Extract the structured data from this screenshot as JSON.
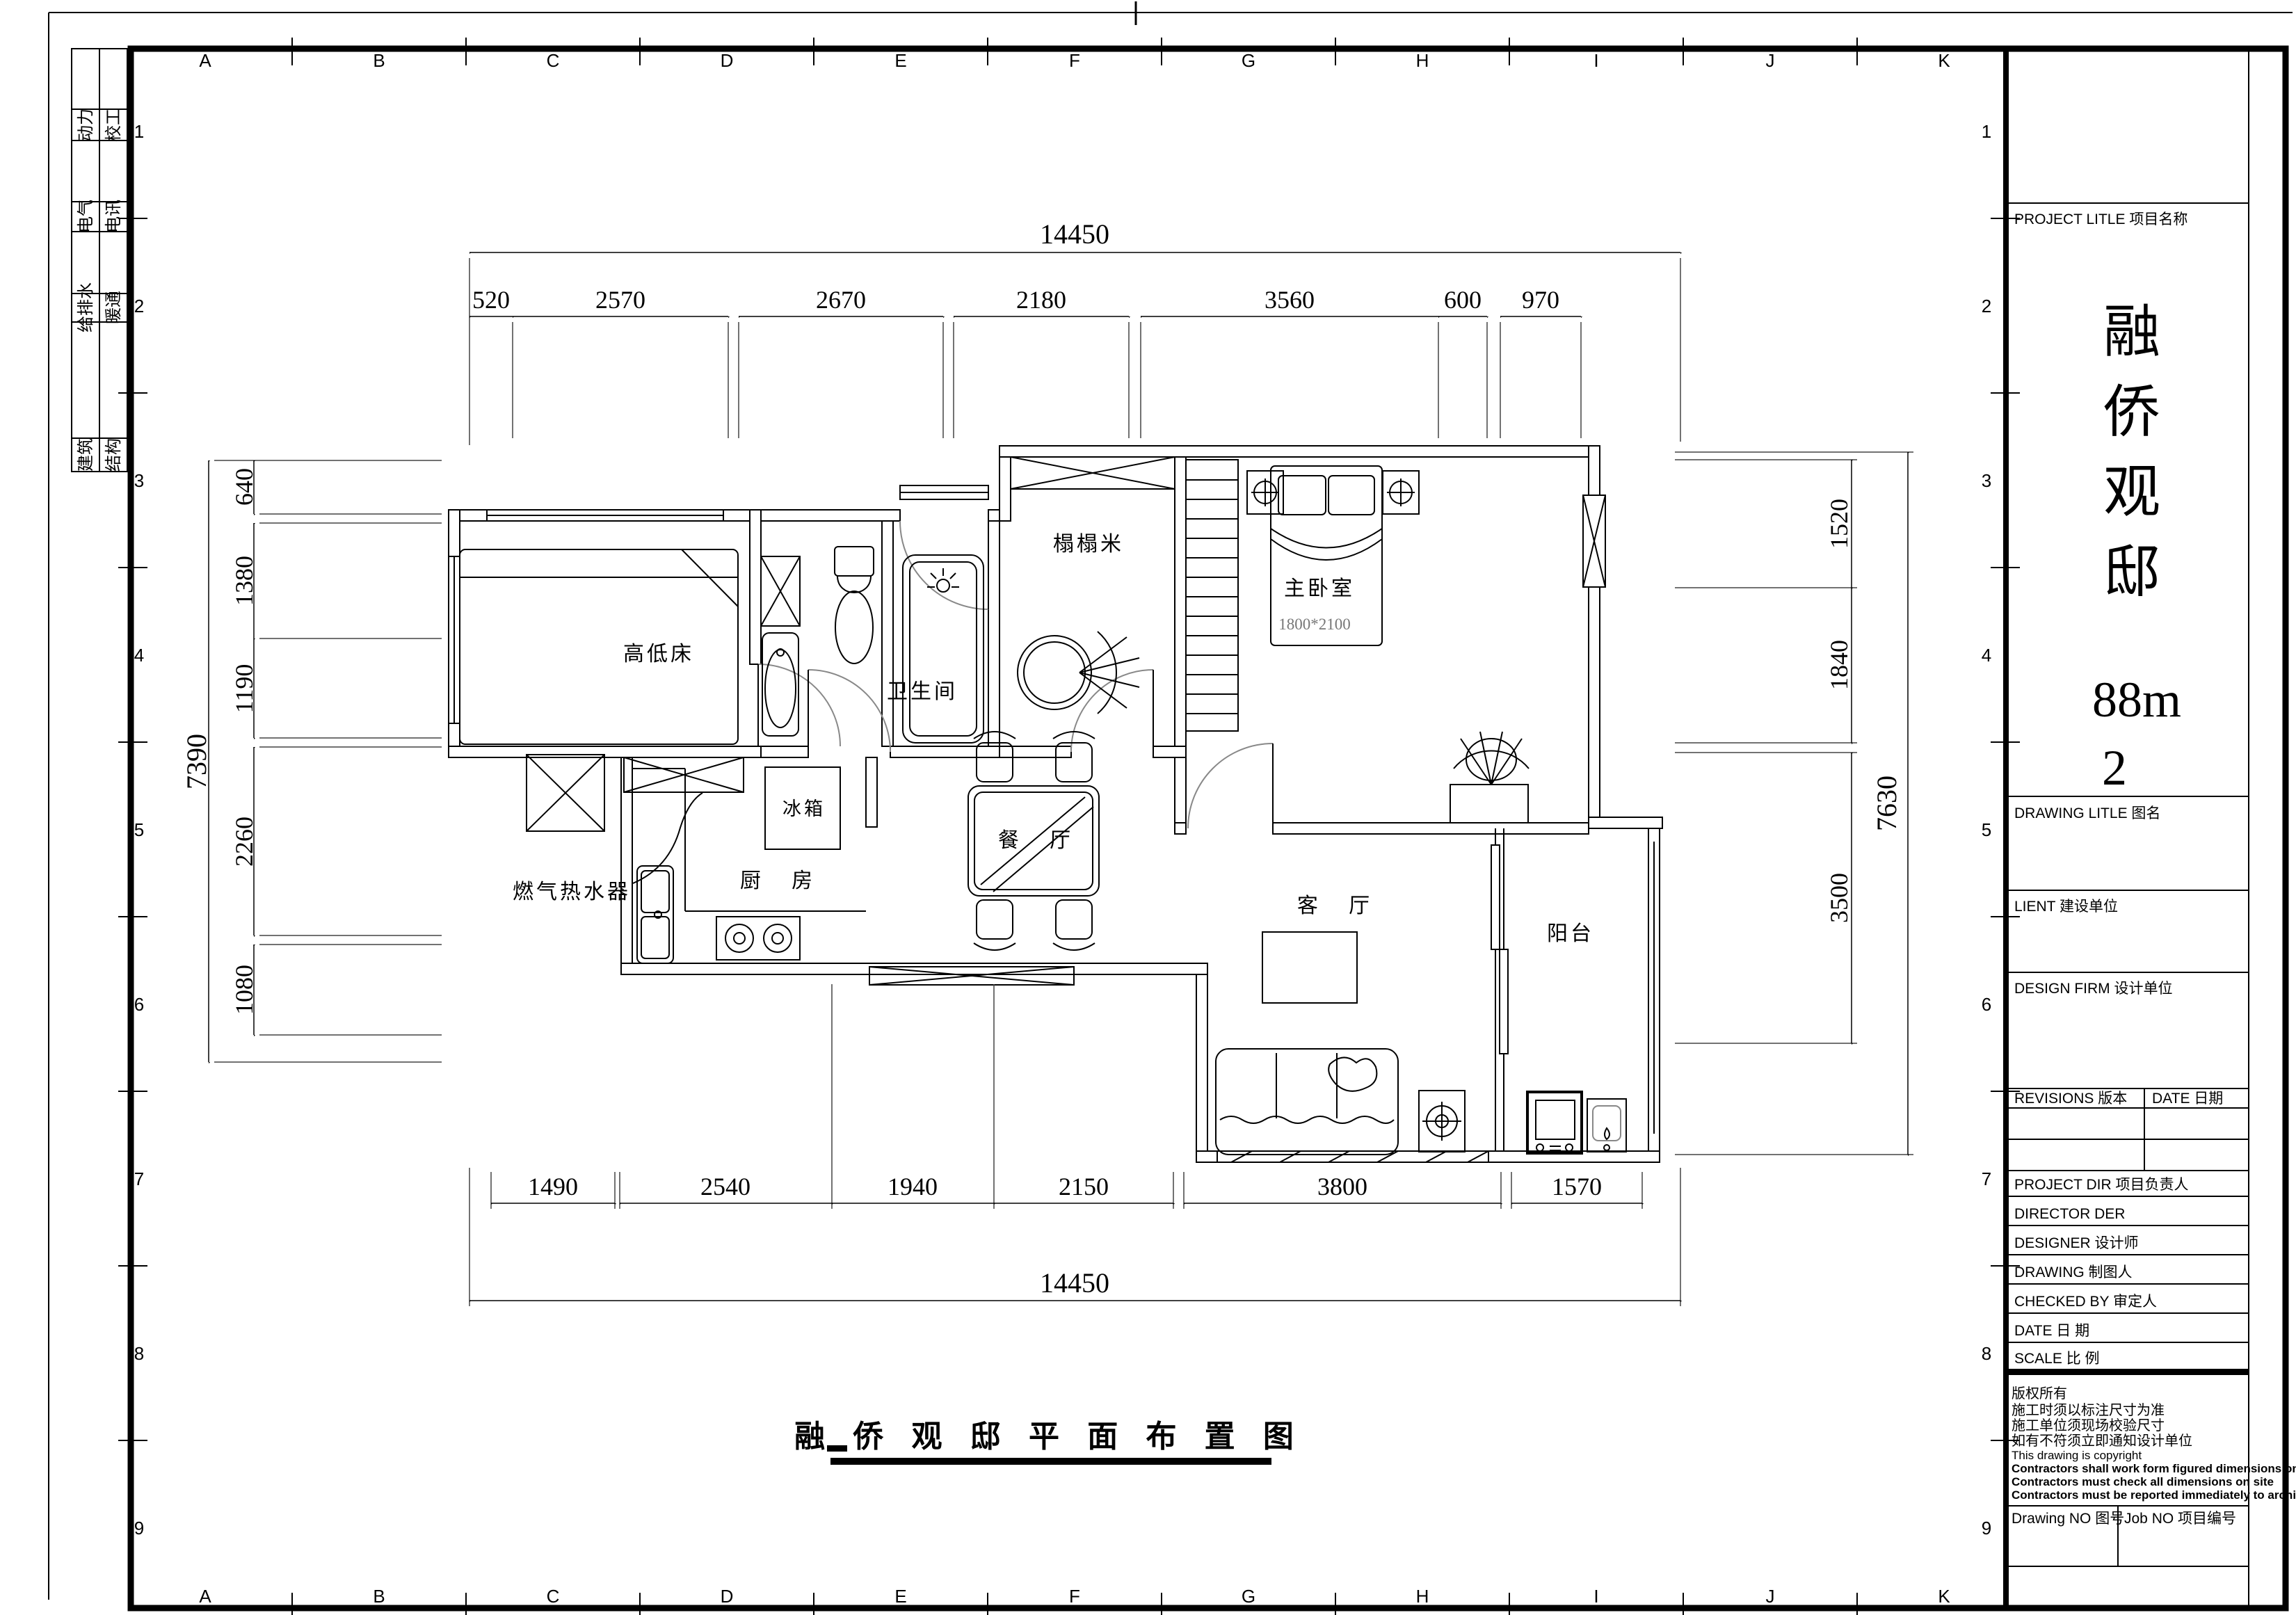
{
  "sheet": {
    "grid_letters": [
      "A",
      "B",
      "C",
      "D",
      "E",
      "F",
      "G",
      "H",
      "I",
      "J",
      "K"
    ],
    "grid_numbers": [
      "1",
      "2",
      "3",
      "4",
      "5",
      "6",
      "7",
      "8",
      "9"
    ],
    "disciplines": [
      "动力",
      "校工",
      "电气",
      "电讯",
      "给排水",
      "暖通",
      "建筑",
      "结构"
    ]
  },
  "plan": {
    "rooms": {
      "children_bed": "高低床",
      "bathroom": "卫生间",
      "tatami": "榻榻米",
      "master": "主卧室",
      "master_bed_size": "1800*2100",
      "fridge": "冰箱",
      "dining": "餐  厅",
      "kitchen": "厨  房",
      "water_heater": "燃气热水器",
      "living": "客  厅",
      "balcony": "阳台"
    },
    "dims": {
      "top_total": "14450",
      "top": [
        "520",
        "2570",
        "2670",
        "2180",
        "3560",
        "600",
        "970"
      ],
      "bottom": [
        "1490",
        "2540",
        "1940",
        "2150",
        "3800",
        "1570"
      ],
      "bottom_total": "14450",
      "left_total": "7390",
      "left": [
        "640",
        "1380",
        "1190",
        "2260",
        "1080"
      ],
      "right": [
        "1520",
        "1840",
        "3500"
      ],
      "right_total": "7630"
    },
    "caption": "融 侨 观 邸 平 面 布 置 图"
  },
  "titleblock": {
    "project_title": "PROJECT LITLE  项目名称",
    "project_name_chars": [
      "融",
      "侨",
      "观",
      "邸",
      "88m",
      "2"
    ],
    "drawing_title": "DRAWING LITLE  图名",
    "client": "LIENT  建设单位",
    "design_firm": "DESIGN FIRM  设计单位",
    "revisions": "REVISIONS  版本",
    "rev_date": "DATE  日期",
    "project_dir": "PROJECT DIR   项目负责人",
    "director": "DIRECTOR DER",
    "designer": "DESIGNER      设计师",
    "drawing": "DRAWING       制图人",
    "checked_by": "CHECKED BY  审定人",
    "date": "DATE             日  期",
    "scale": "SCALE            比  例",
    "copyright": [
      "版权所有",
      "施工时须以标注尺寸为准",
      "施工单位须现场校验尺寸",
      "如有不符须立即通知设计单位",
      "This drawing is copyright",
      "Contractors shall work form figured dimensions only",
      "Contractors must check all dimensions on site",
      "Contractors must be reported immediately to architects"
    ],
    "drawing_no": "Drawing NO  图号",
    "job_no": "Job NO  项目编号"
  }
}
